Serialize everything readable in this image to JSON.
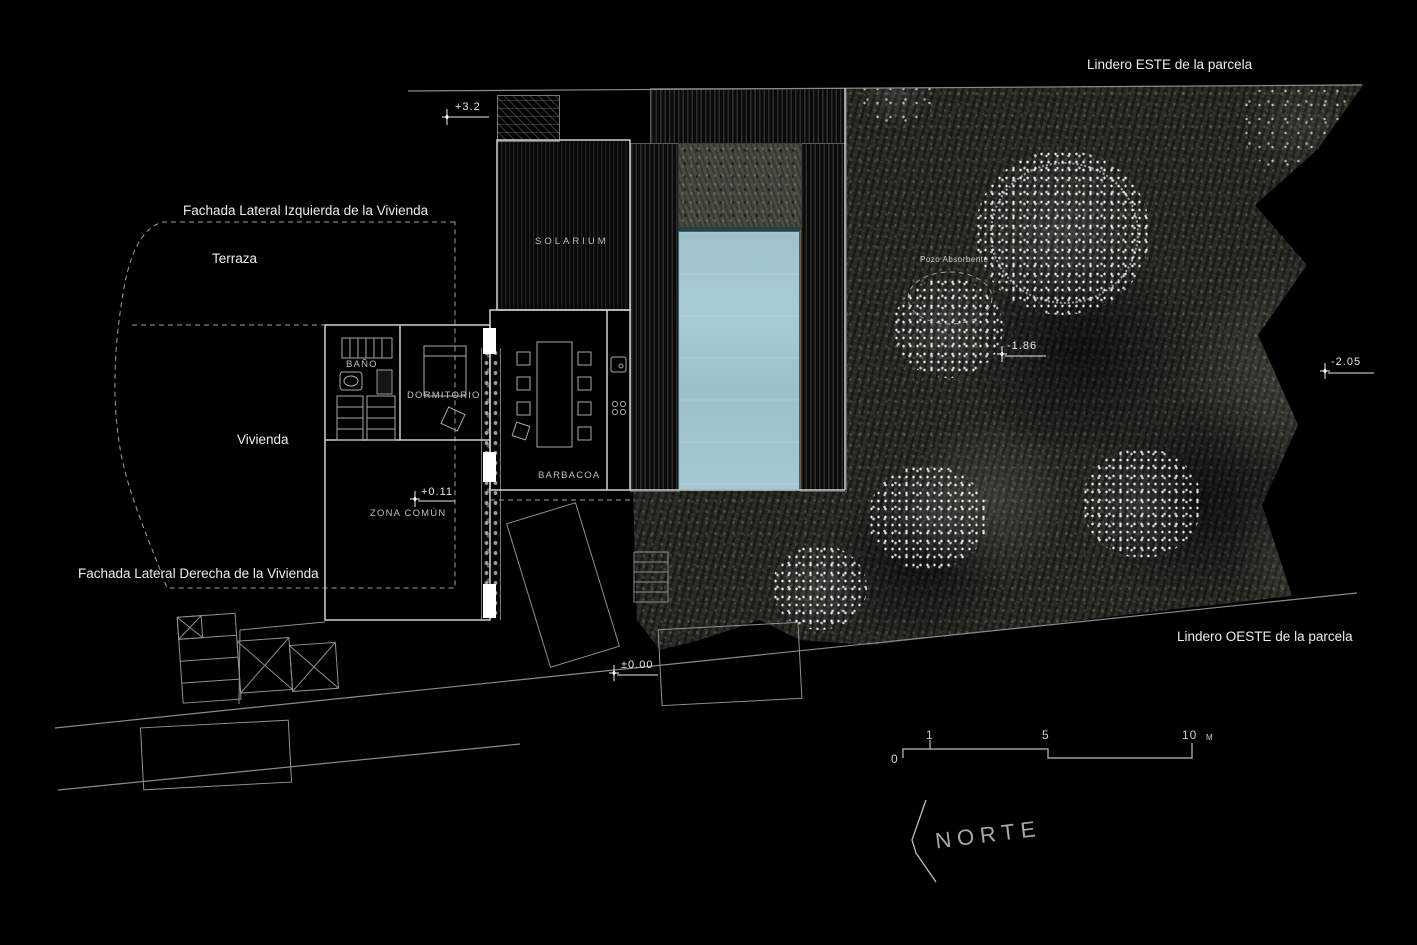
{
  "boundaries": {
    "este": "Lindero ESTE de la parcela",
    "oeste": "Lindero OESTE de la parcela"
  },
  "facades": {
    "izquierda": "Fachada Lateral Izquierda de la Vivienda",
    "derecha": "Fachada Lateral Derecha de la Vivienda"
  },
  "rooms": {
    "terraza": "Terraza",
    "vivienda": "Vivienda",
    "solarium": "SOLARIUM",
    "barbacoa": "BARBACOA",
    "zona_comun": "ZONA COMÚN",
    "dormitorio": "DORMITORIO",
    "bano": "BAÑO"
  },
  "site": {
    "pozo_absorbente": "Pozo Absorbente"
  },
  "levels": [
    {
      "value": "+3.2"
    },
    {
      "value": "+0.11"
    },
    {
      "value": "±0.00"
    },
    {
      "value": "-1.86"
    },
    {
      "value": "-2.05"
    }
  ],
  "scale_bar": {
    "labels": [
      "0",
      "1",
      "5",
      "10"
    ],
    "unit": "M"
  },
  "north_label": "NORTE",
  "colors": {
    "background": "#000000",
    "line": "#d9d9d9",
    "pool_water": "#a3c7cf",
    "garden_base": "#272a23",
    "vegetation_highlight": "#ffffff"
  }
}
